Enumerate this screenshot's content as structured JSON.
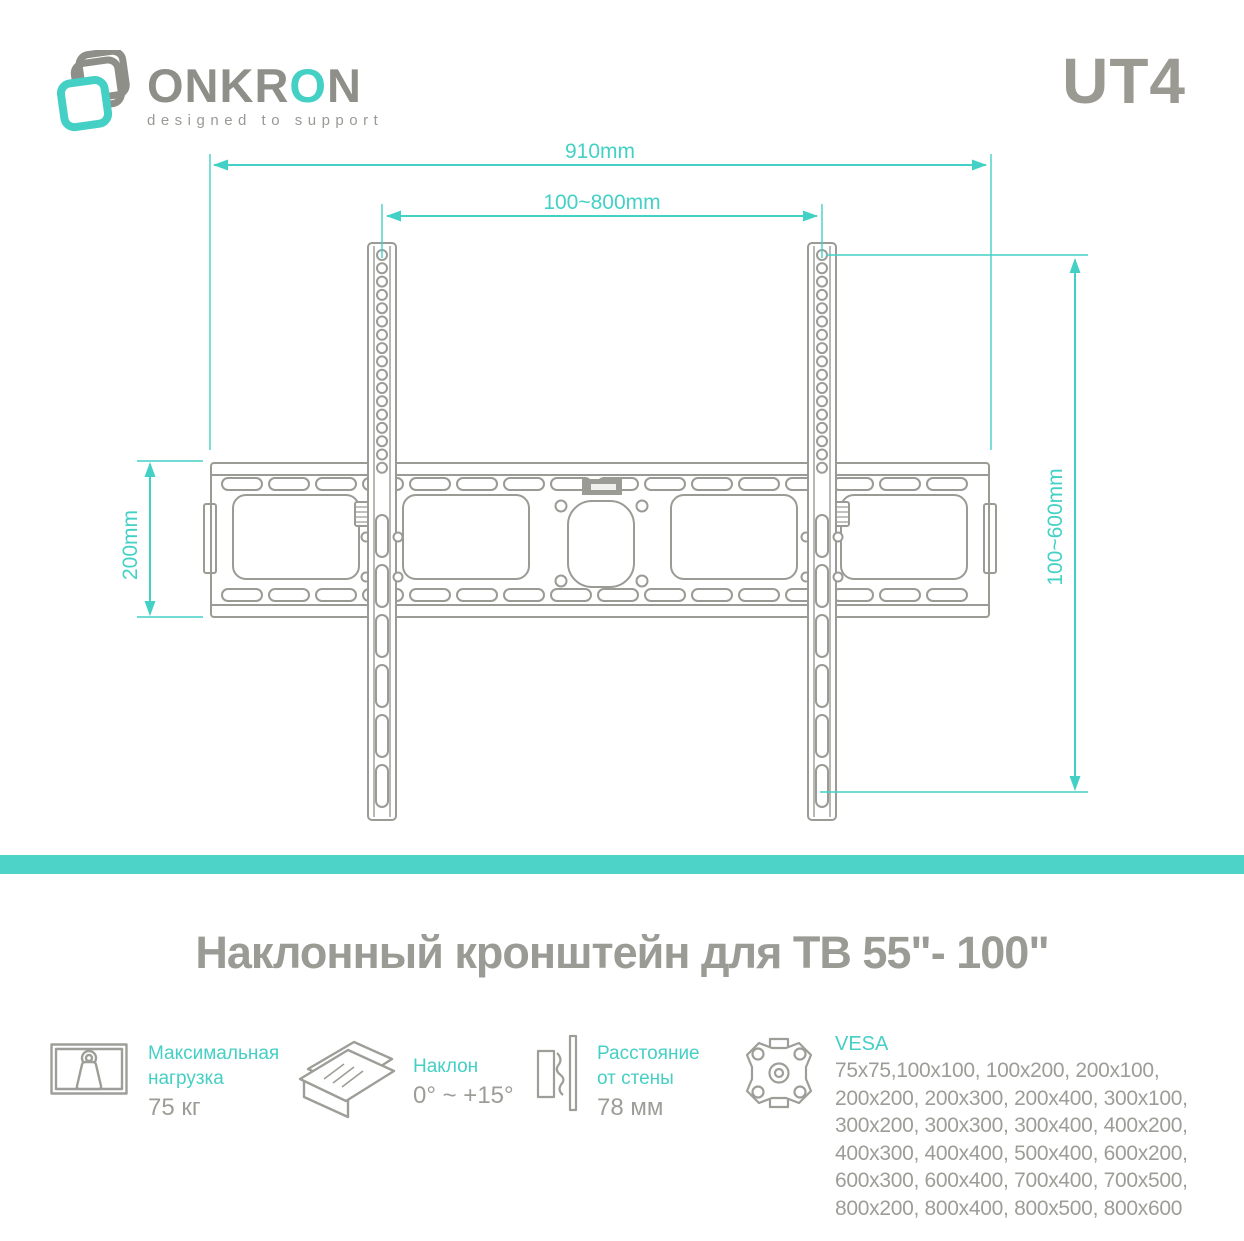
{
  "header": {
    "brand_part1": "ONKR",
    "brand_teal": "O",
    "brand_part2": "N",
    "tagline": "designed to support",
    "model": "UT4"
  },
  "diagram": {
    "dim_width_total": "910mm",
    "dim_width_vesa": "100~800mm",
    "dim_height_left": "200mm",
    "dim_height_vesa": "100~600mm"
  },
  "diagram_geometry": {
    "plate_slots": {
      "count": 16,
      "x0": 222,
      "pitch": 47,
      "w": 40,
      "h": 12,
      "rows": [
        478,
        589
      ]
    },
    "rail_holes": {
      "count": 17,
      "y0": 255,
      "pitch": 13.3,
      "r": 5,
      "cx": [
        382,
        822
      ]
    },
    "rail_slots": {
      "count": 6,
      "y0": 515,
      "pitch": 50,
      "w": 12,
      "h": 42,
      "x": [
        376,
        816
      ]
    }
  },
  "title": "Наклонный кронштейн для ТВ 55\"- 100\"",
  "specs": [
    {
      "icon": "max-load-icon",
      "label": "Максимальная\nнагрузка",
      "value": "75 кг"
    },
    {
      "icon": "tilt-icon",
      "label": "Наклон",
      "value": "0° ~ +15°"
    },
    {
      "icon": "wall-distance-icon",
      "label": "Расстояние\nот стены",
      "value": "78 мм"
    },
    {
      "icon": "vesa-icon",
      "label": "VESA",
      "value": "75x75,100x100, 100x200, 200x100,\n200x200, 200x300, 200x400, 300x100,\n300x200, 300x300, 300x400, 400x200,\n400x300, 400x400, 500x400, 600x200,\n600x300, 600x400, 700x400, 700x500,\n800x200, 800x400, 800x500, 800x600"
    }
  ],
  "colors": {
    "teal": "#43d1c6",
    "divider": "#4ed3c9",
    "line_gray": "#9b9b95",
    "text_gray": "#9d9d98"
  }
}
